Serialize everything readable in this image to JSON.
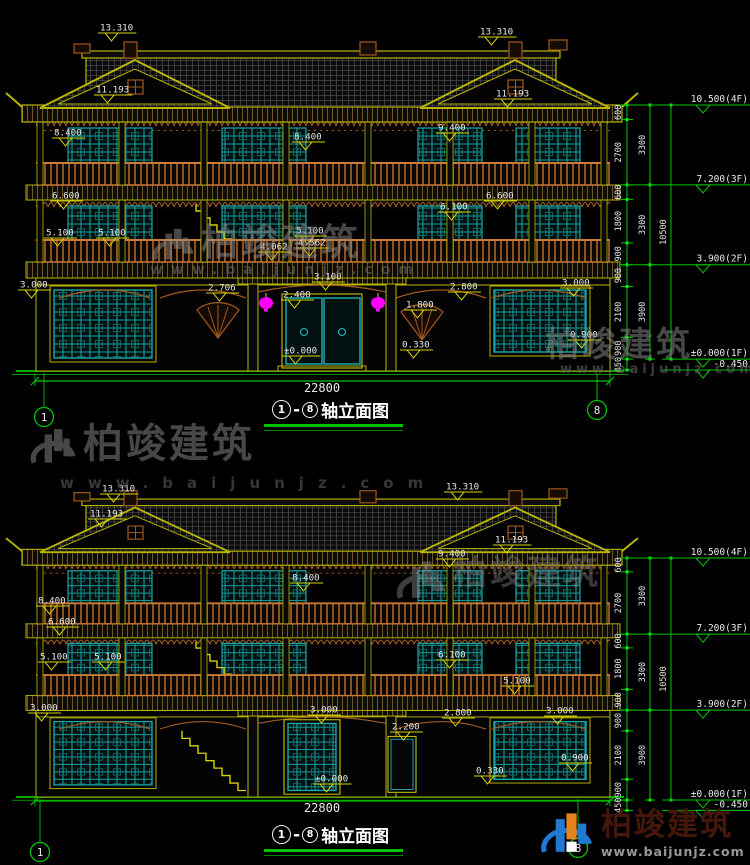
{
  "watermark": {
    "brand": "柏竣建筑",
    "url": "www.baijunjz.com"
  },
  "logo": {
    "brand": "柏竣建筑",
    "url": "www.baijunjz.com"
  },
  "views": [
    {
      "name": "top-elevation",
      "caption": {
        "axis_start": "1",
        "separator": "-",
        "axis_end": "8",
        "label": "轴立面图"
      },
      "axis_bubbles": [
        "1",
        "8"
      ],
      "overall": "22800",
      "levels": [
        {
          "label": "10.500(4F)",
          "mm": 0
        },
        {
          "label": "7.200(3F)",
          "mm": 3300
        },
        {
          "label": "3.900(2F)",
          "mm": 6600
        },
        {
          "label": "±0.000(1F)",
          "mm": 10500
        },
        {
          "label": "-0.450",
          "mm": 10950
        }
      ],
      "dims": {
        "inner": [
          "600",
          "2700",
          "600",
          "1800",
          "900",
          "900",
          "2100",
          "900"
        ],
        "mid": [
          "3300",
          "3300",
          "3900"
        ],
        "outer": [
          "10500"
        ],
        "base": "450"
      },
      "markers": [
        {
          "t": "13.310",
          "x": 100,
          "y": 22
        },
        {
          "t": "13.310",
          "x": 480,
          "y": 26
        },
        {
          "t": "11.193",
          "x": 96,
          "y": 84
        },
        {
          "t": "11.193",
          "x": 496,
          "y": 88
        },
        {
          "t": "9.400",
          "x": 438,
          "y": 122
        },
        {
          "t": "8.400",
          "x": 54,
          "y": 127
        },
        {
          "t": "8.400",
          "x": 294,
          "y": 131
        },
        {
          "t": "6.600",
          "x": 52,
          "y": 190
        },
        {
          "t": "6.600",
          "x": 486,
          "y": 190
        },
        {
          "t": "6.100",
          "x": 440,
          "y": 201
        },
        {
          "t": "5.100",
          "x": 46,
          "y": 227
        },
        {
          "t": "5.100",
          "x": 98,
          "y": 227
        },
        {
          "t": "5.100",
          "x": 296,
          "y": 225
        },
        {
          "t": "4.562",
          "x": 298,
          "y": 237
        },
        {
          "t": "4.062",
          "x": 260,
          "y": 241
        },
        {
          "t": "3.100",
          "x": 314,
          "y": 271
        },
        {
          "t": "2.706",
          "x": 208,
          "y": 282
        },
        {
          "t": "2.400",
          "x": 283,
          "y": 289
        },
        {
          "t": "2.800",
          "x": 450,
          "y": 281
        },
        {
          "t": "1.800",
          "x": 406,
          "y": 299
        },
        {
          "t": "3.000",
          "x": 20,
          "y": 279
        },
        {
          "t": "3.000",
          "x": 562,
          "y": 277
        },
        {
          "t": "0.900",
          "x": 570,
          "y": 329
        },
        {
          "t": "0.330",
          "x": 402,
          "y": 339
        },
        {
          "t": "±0.000",
          "x": 284,
          "y": 345
        }
      ]
    },
    {
      "name": "bottom-elevation",
      "caption": {
        "axis_start": "1",
        "separator": "-",
        "axis_end": "8",
        "label": "轴立面图"
      },
      "axis_bubbles": [
        "1",
        "8"
      ],
      "overall": "22800",
      "levels": [
        {
          "label": "10.500(4F)",
          "mm": 0
        },
        {
          "label": "7.200(3F)",
          "mm": 3300
        },
        {
          "label": "3.900(2F)",
          "mm": 6600
        },
        {
          "label": "±0.000(1F)",
          "mm": 10500
        },
        {
          "label": "-0.450",
          "mm": 10950
        }
      ],
      "dims": {
        "inner": [
          "600",
          "2700",
          "600",
          "1800",
          "900",
          "900",
          "2100",
          "900"
        ],
        "mid": [
          "3300",
          "3300",
          "3900"
        ],
        "outer": [
          "10500"
        ],
        "base": "450"
      },
      "markers": [
        {
          "t": "13.310",
          "x": 102,
          "y": 483
        },
        {
          "t": "13.310",
          "x": 446,
          "y": 481
        },
        {
          "t": "11.193",
          "x": 90,
          "y": 508
        },
        {
          "t": "11.193",
          "x": 495,
          "y": 534
        },
        {
          "t": "9.400",
          "x": 438,
          "y": 548
        },
        {
          "t": "8.400",
          "x": 38,
          "y": 595
        },
        {
          "t": "8.400",
          "x": 292,
          "y": 572
        },
        {
          "t": "6.600",
          "x": 48,
          "y": 616
        },
        {
          "t": "6.100",
          "x": 438,
          "y": 649
        },
        {
          "t": "5.100",
          "x": 40,
          "y": 651
        },
        {
          "t": "5.100",
          "x": 94,
          "y": 651
        },
        {
          "t": "5.100",
          "x": 503,
          "y": 675
        },
        {
          "t": "3.000",
          "x": 30,
          "y": 702
        },
        {
          "t": "3.000",
          "x": 310,
          "y": 704
        },
        {
          "t": "3.000",
          "x": 546,
          "y": 705
        },
        {
          "t": "2.800",
          "x": 444,
          "y": 707
        },
        {
          "t": "2.200",
          "x": 392,
          "y": 721
        },
        {
          "t": "±0.000",
          "x": 315,
          "y": 773
        },
        {
          "t": "0.330",
          "x": 476,
          "y": 765
        },
        {
          "t": "0.900",
          "x": 561,
          "y": 752
        }
      ]
    }
  ]
}
